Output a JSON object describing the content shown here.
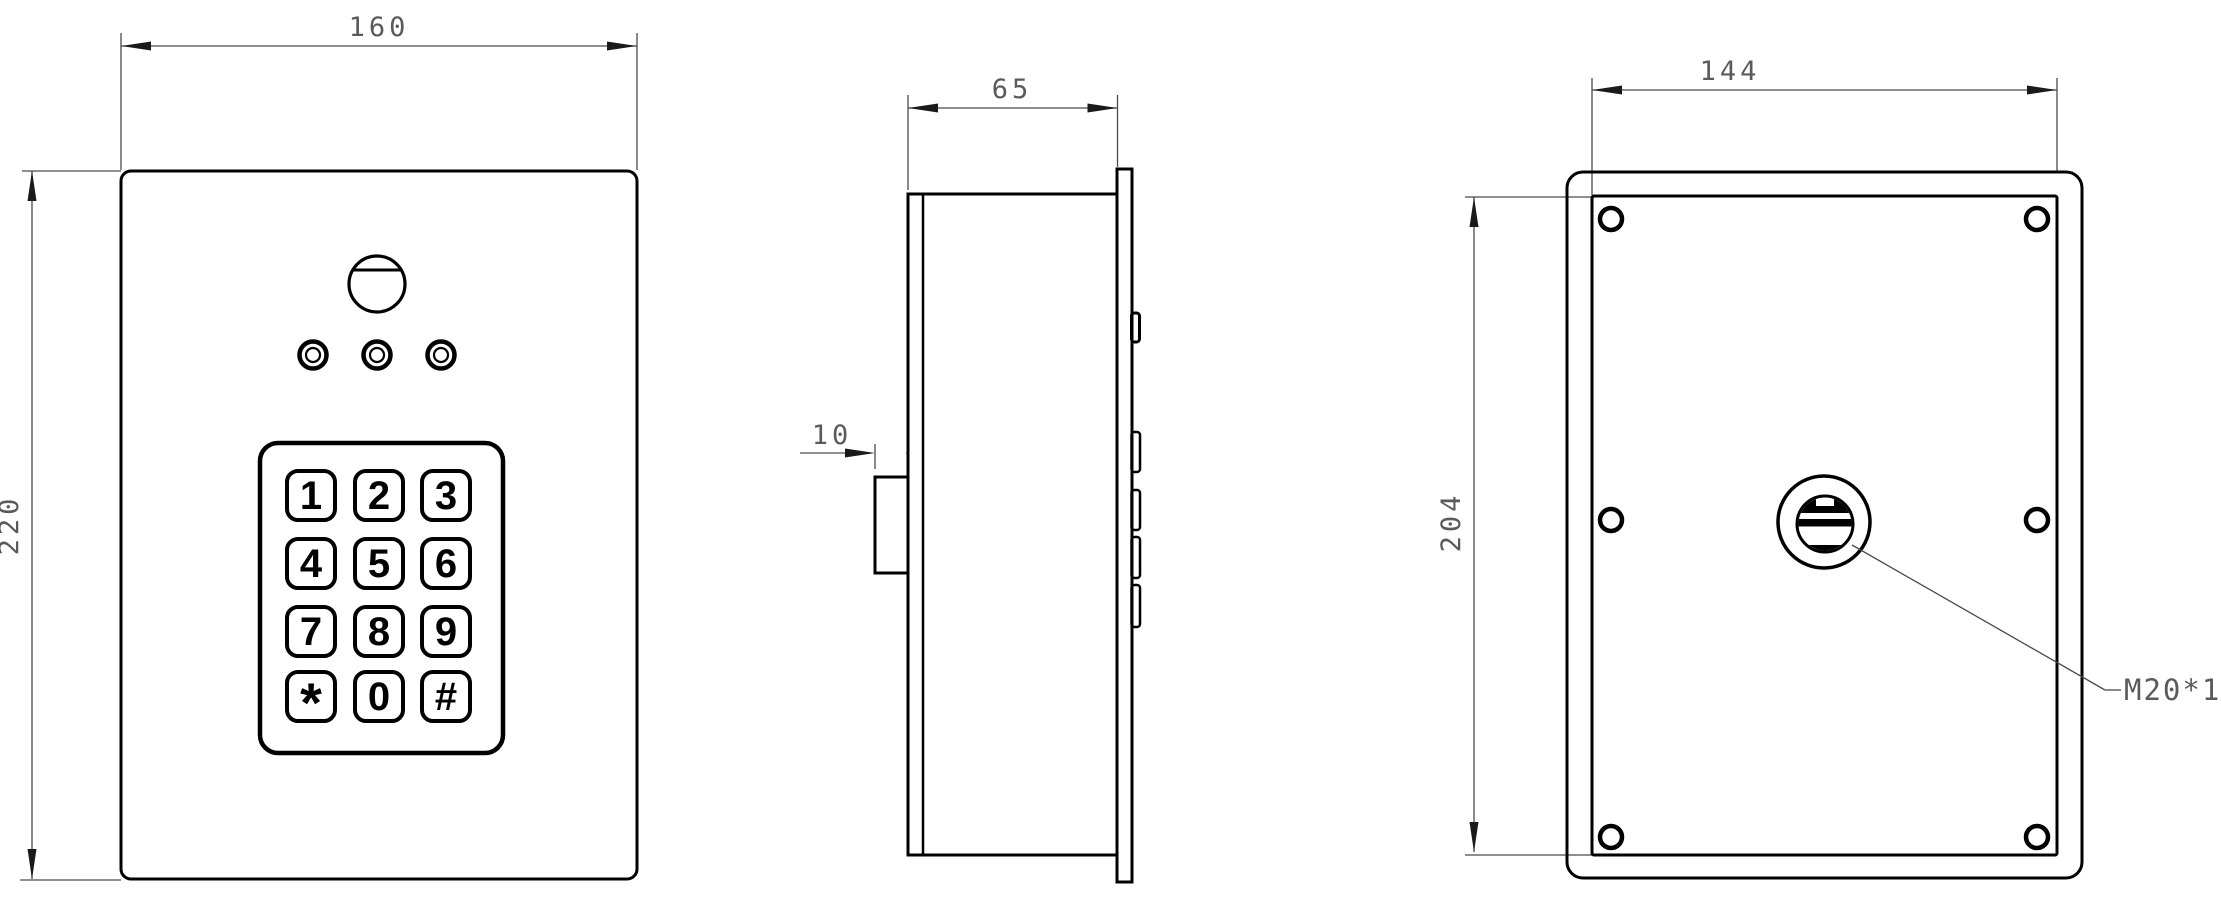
{
  "drawing": {
    "type": "engineering-orthographic-views",
    "subject": "keypad access control unit",
    "colors": {
      "line": "#000000",
      "dimension": "#4a4a4a",
      "background": "#ffffff"
    },
    "views": {
      "front": {
        "width_dim": "160",
        "height_dim": "220",
        "keypad_keys": [
          "1",
          "2",
          "3",
          "4",
          "5",
          "6",
          "7",
          "8",
          "9",
          "*",
          "0",
          "#"
        ]
      },
      "side": {
        "depth_dim": "65",
        "flange_dim": "10"
      },
      "back": {
        "width_dim": "144",
        "height_dim": "204",
        "gland_label": "M20*1.5"
      }
    }
  }
}
